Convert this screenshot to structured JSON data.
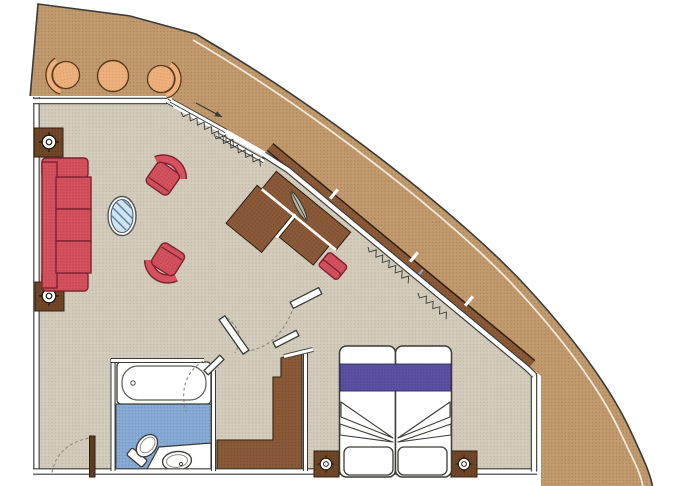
{
  "plan": {
    "kind": "cruise-ship-suite-floor-plan",
    "has_text": false
  },
  "colors": {
    "background": "#ffffff",
    "hull_deck_tan": "#c19a6d",
    "interior_floor": "#d3ccbc",
    "bathroom_floor": "#87abd4",
    "wood_brown": "#8a5a38",
    "dark_wood": "#6f4627",
    "upholstery_red": "#d4525f",
    "balcony_chair_orange": "#edb07c",
    "bed_runner_purple": "#5b50a1",
    "glass_table_blue": "#cfe4f4",
    "line": "#3a3a36",
    "swing_arc_gray": "#8a877e"
  },
  "semantics": {
    "hull": "ship hull and deck band",
    "balcony": "private balcony",
    "balcony_chair_left": "balcony tub chair",
    "balcony_table": "balcony round table",
    "balcony_chair_right": "balcony tub chair",
    "living_room": "living room",
    "sofa": "three-seat sofa",
    "armchair": "armchair",
    "coffee_table": "oval glass coffee table",
    "side_table": "side table with ceiling light symbol",
    "light_symbol": "ceiling light symbol",
    "desk_unit": "desk and cabinet unit",
    "desk_stool": "desk stool",
    "desk_lamp": "wall light symbol",
    "sliding_door": "sliding balcony door with curtain",
    "window_band": "panoramic window band",
    "curtain": "curtain zigzag",
    "bedroom": "sleeping area",
    "bed": "double bed (two mattresses)",
    "pillow": "pillow",
    "nightstand": "nightstand with light symbol",
    "wardrobe": "stepped wardrobe closet",
    "bathroom": "bathroom",
    "bathtub": "bathtub",
    "toilet": "toilet",
    "washbasin": "washbasin counter",
    "entry_door": "entry door with swing arc",
    "interior_door": "interior door leaf",
    "swing_arc": "door swing arc"
  }
}
